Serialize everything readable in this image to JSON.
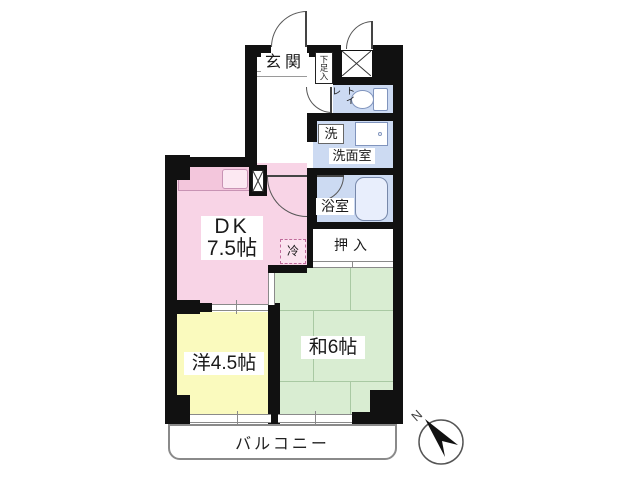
{
  "plan": {
    "entrance": {
      "label": "玄関"
    },
    "shoe_cabinet": {
      "label": "下足入"
    },
    "toilet": {
      "label": "トイレ"
    },
    "laundry": {
      "label": "洗"
    },
    "washroom": {
      "label": "洗面室"
    },
    "bathroom": {
      "label": "浴室"
    },
    "dining_kitchen": {
      "label_line1": "DK",
      "label_line2": "7.5帖"
    },
    "refrigerator": {
      "label": "冷"
    },
    "closet": {
      "label": "押入"
    },
    "japanese_room": {
      "label": "和6帖"
    },
    "western_room": {
      "label": "洋4.5帖"
    },
    "balcony": {
      "label": "バルコニー"
    }
  },
  "compass": {
    "north_label": "N"
  },
  "colors": {
    "wall": "#111111",
    "dk_pink": "#f8d4e6",
    "western_yellow": "#fafabe",
    "japanese_green": "#d9edd2",
    "wet_area_blue": "#ccdaf2"
  }
}
